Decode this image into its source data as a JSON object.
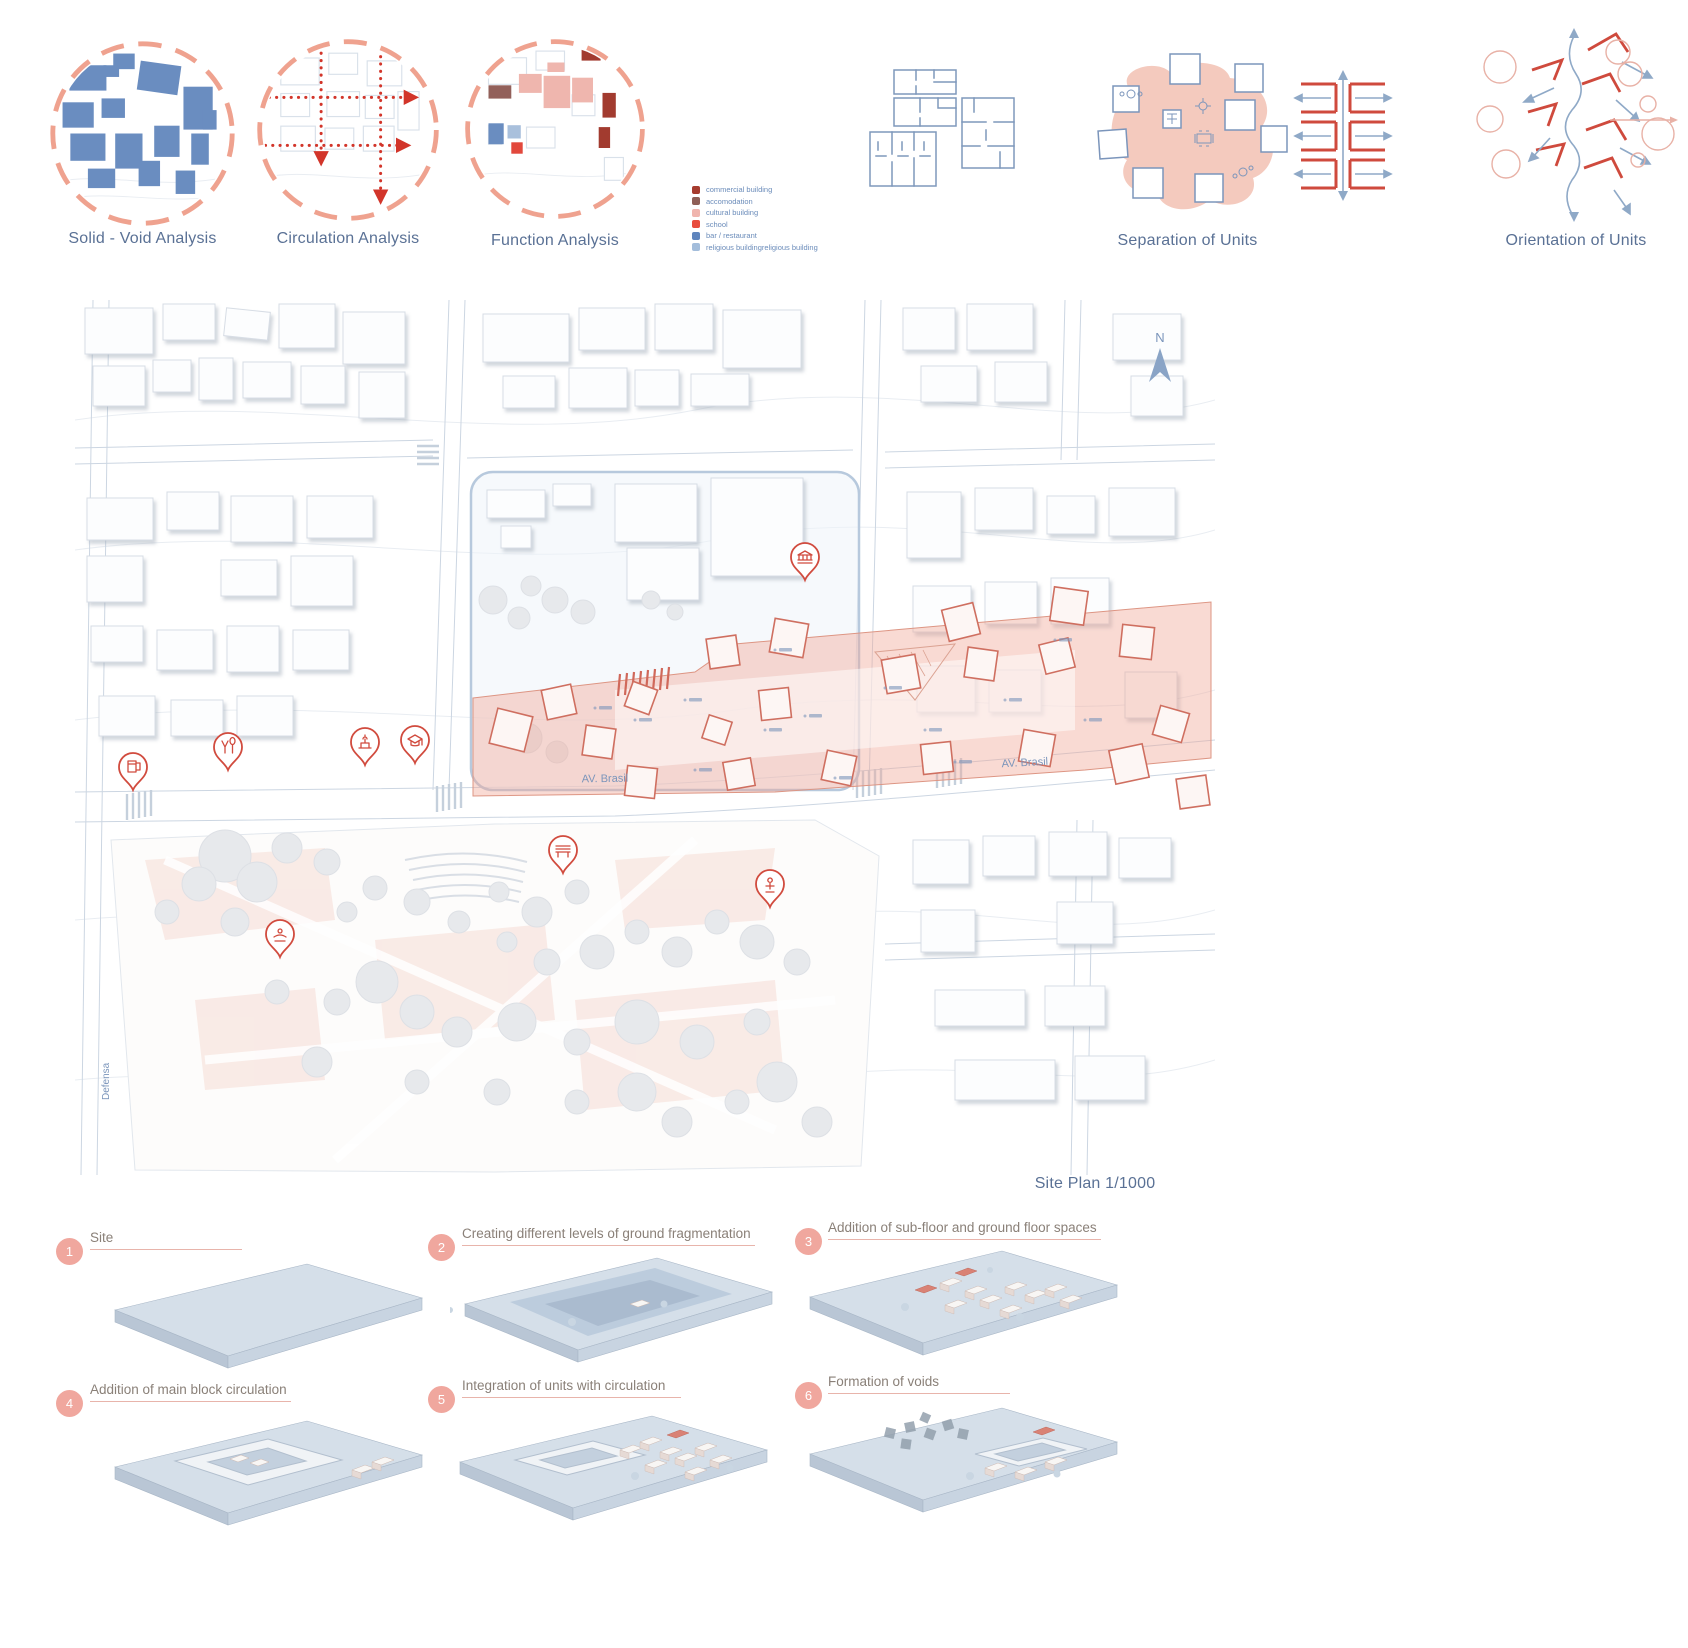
{
  "board": {
    "analysis": [
      {
        "label": "Solid - Void Analysis"
      },
      {
        "label": "Circulation Analysis"
      },
      {
        "label": "Function Analysis"
      }
    ],
    "legend": [
      {
        "label": "commercial building",
        "color": "#a63c2f"
      },
      {
        "label": "accomodation",
        "color": "#8f5f57"
      },
      {
        "label": "cultural building",
        "color": "#f0b5ae"
      },
      {
        "label": "school",
        "color": "#e84c3d"
      },
      {
        "label": "bar / restaurant",
        "color": "#5f85bd"
      },
      {
        "label": "religious buildingreligious building",
        "color": "#a3bddb"
      }
    ],
    "unit_diagrams": [
      {
        "label": "Separation of Units"
      },
      {
        "label": "Orientation of Units"
      }
    ],
    "site_plan": {
      "caption": "Site Plan 1/1000",
      "north_label": "N",
      "streets": [
        {
          "label": "AV. Brasil"
        },
        {
          "label": "AV. Brasil"
        },
        {
          "label": "Defensa"
        }
      ],
      "pins": [
        {
          "icon": "beer-mug"
        },
        {
          "icon": "restaurant"
        },
        {
          "icon": "landmark"
        },
        {
          "icon": "graduation-cap"
        },
        {
          "icon": "museum"
        },
        {
          "icon": "bench"
        },
        {
          "icon": "statue"
        },
        {
          "icon": "fountain"
        }
      ]
    },
    "steps": [
      {
        "number": "1",
        "label": "Site"
      },
      {
        "number": "2",
        "label": "Creating different levels of  ground fragmentation"
      },
      {
        "number": "3",
        "label": "Addition of sub-floor and ground floor spaces"
      },
      {
        "number": "4",
        "label": "Addition of  main block circulation"
      },
      {
        "number": "5",
        "label": "Integration of units with circulation"
      },
      {
        "number": "6",
        "label": "Formation of voids"
      }
    ],
    "colors": {
      "salmon": "#efa28f",
      "red": "#d14b3e",
      "blue": "#6a8dc0",
      "text_blue": "#5a7195",
      "pink_fill": "#f4cabe"
    }
  }
}
